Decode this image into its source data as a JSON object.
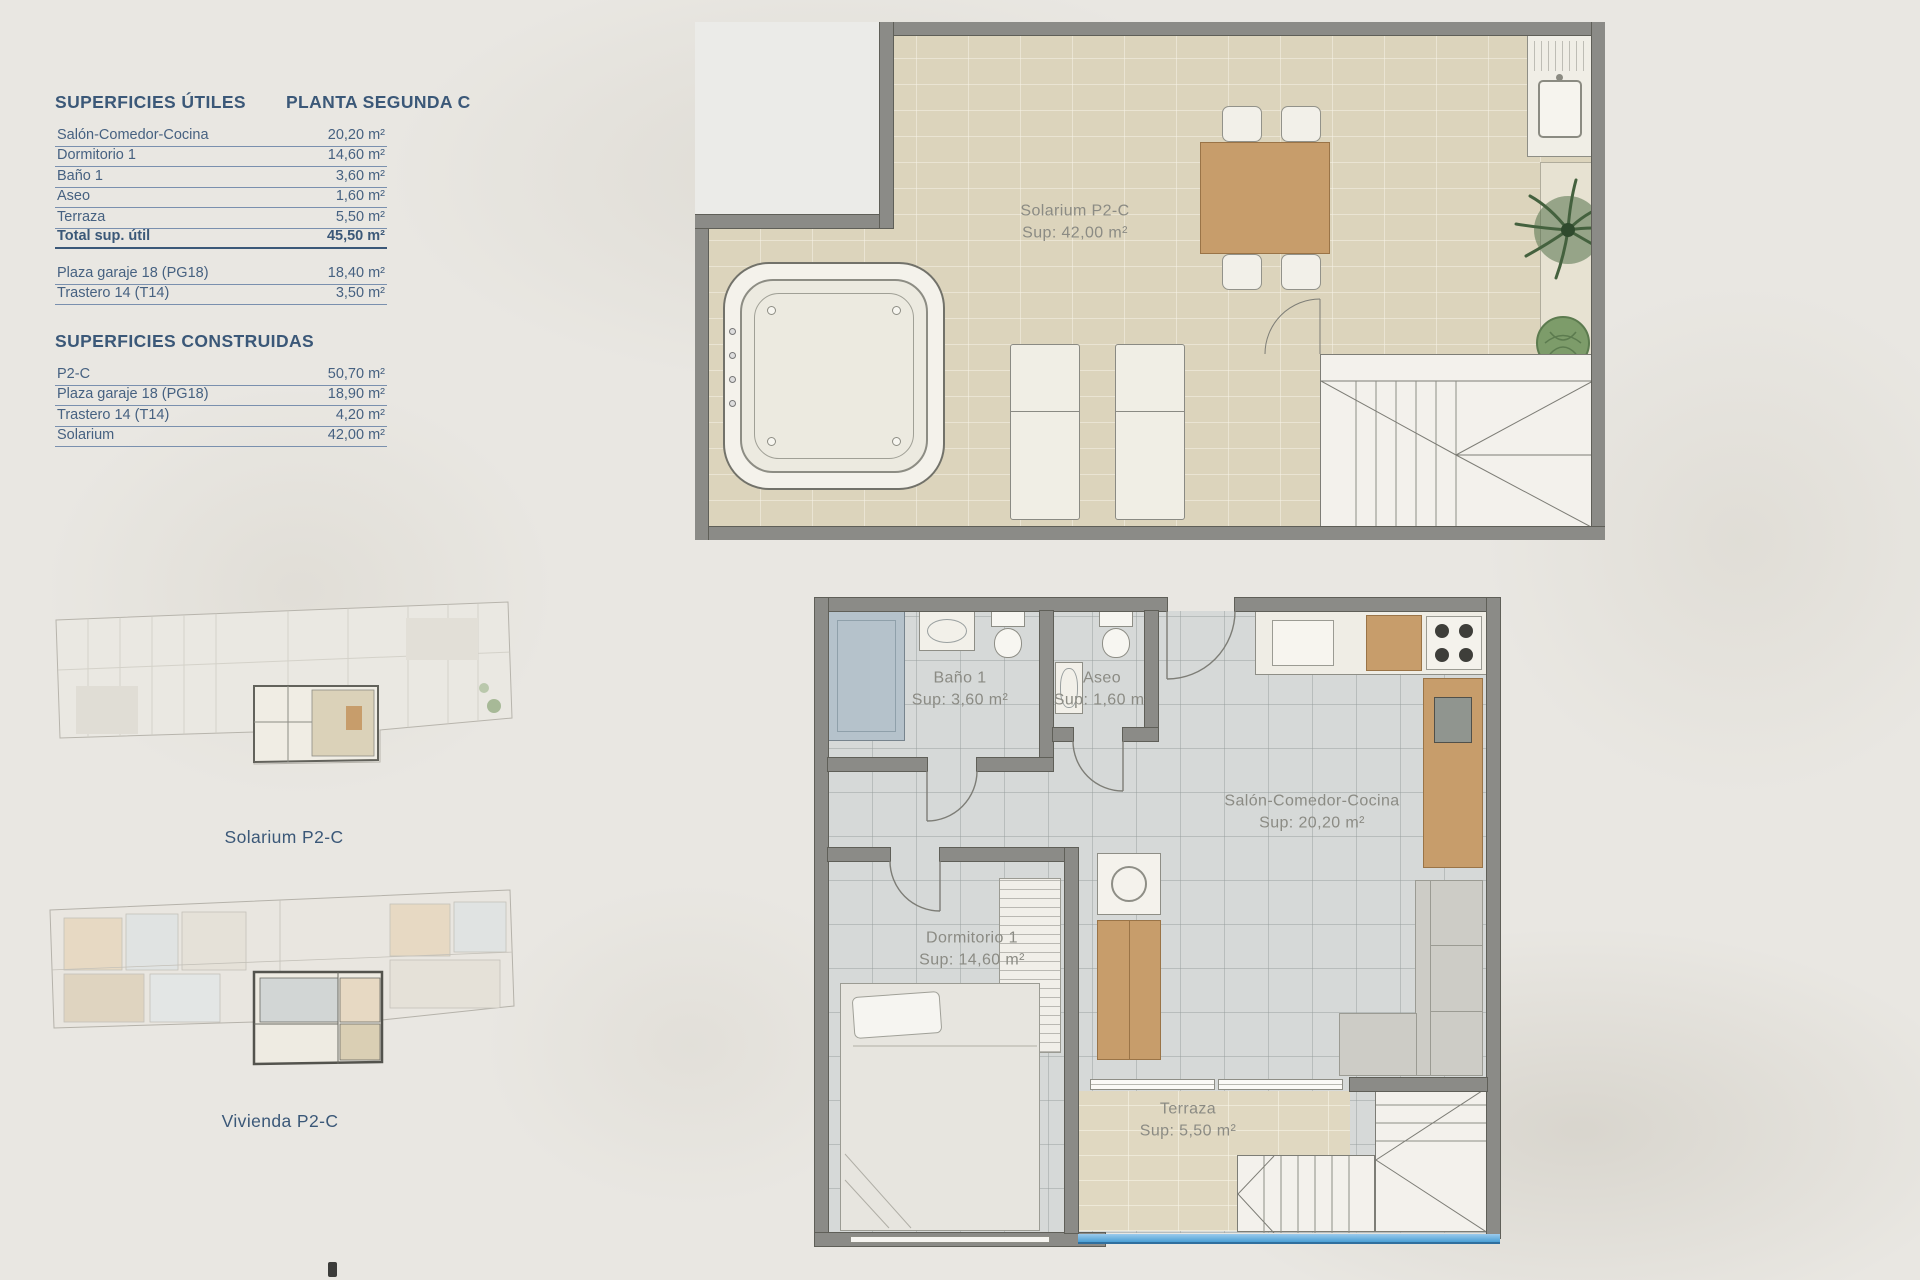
{
  "tables": {
    "utiles": {
      "title": "SUPERFICIES ÚTILES",
      "subtitle": "PLANTA SEGUNDA C",
      "rows": [
        {
          "label": "Salón-Comedor-Cocina",
          "value": "20,20 m²"
        },
        {
          "label": "Dormitorio 1",
          "value": "14,60 m²"
        },
        {
          "label": "Baño 1",
          "value": "3,60 m²"
        },
        {
          "label": "Aseo",
          "value": "1,60 m²"
        },
        {
          "label": "Terraza",
          "value": "5,50 m²"
        }
      ],
      "total": {
        "label": "Total sup. útil",
        "value": "45,50 m²"
      },
      "extra": [
        {
          "label": "Plaza garaje 18 (PG18)",
          "value": "18,40 m²"
        },
        {
          "label": "Trastero 14 (T14)",
          "value": "3,50 m²"
        }
      ]
    },
    "construidas": {
      "title": "SUPERFICIES CONSTRUIDAS",
      "rows": [
        {
          "label": "P2-C",
          "value": "50,70 m²"
        },
        {
          "label": "Plaza garaje 18 (PG18)",
          "value": "18,90 m²"
        },
        {
          "label": "Trastero 14 (T14)",
          "value": "4,20 m²"
        },
        {
          "label": "Solarium",
          "value": "42,00 m²"
        }
      ]
    }
  },
  "plans": {
    "solarium": {
      "title": "Solarium P2-C",
      "sup": "Sup: 42,00 m²"
    },
    "vivienda": {
      "rooms": {
        "bano": {
          "name": "Baño 1",
          "sup": "Sup: 3,60 m²"
        },
        "aseo": {
          "name": "Aseo",
          "sup": "Sup: 1,60 m²"
        },
        "salon": {
          "name": "Salón-Comedor-Cocina",
          "sup": "Sup: 20,20 m²"
        },
        "dormitorio": {
          "name": "Dormitorio 1",
          "sup": "Sup: 14,60 m²"
        },
        "terraza": {
          "name": "Terraza",
          "sup": "Sup: 5,50 m²"
        }
      }
    }
  },
  "minis": {
    "solarium_caption": "Solarium P2-C",
    "vivienda_caption": "Vivienda P2-C"
  },
  "colors": {
    "navy_text": "#3b5878",
    "wall_gray": "#8b8b87",
    "solarium_tile": "#dcd4bc",
    "interior_tile": "#d6d9d8",
    "terrace_tile": "#e0d8c1",
    "wood": "#c79d6b",
    "balustrade_blue": "#4a9fd4",
    "label_gray": "#8b8b84",
    "background": "#e9e7e2"
  }
}
